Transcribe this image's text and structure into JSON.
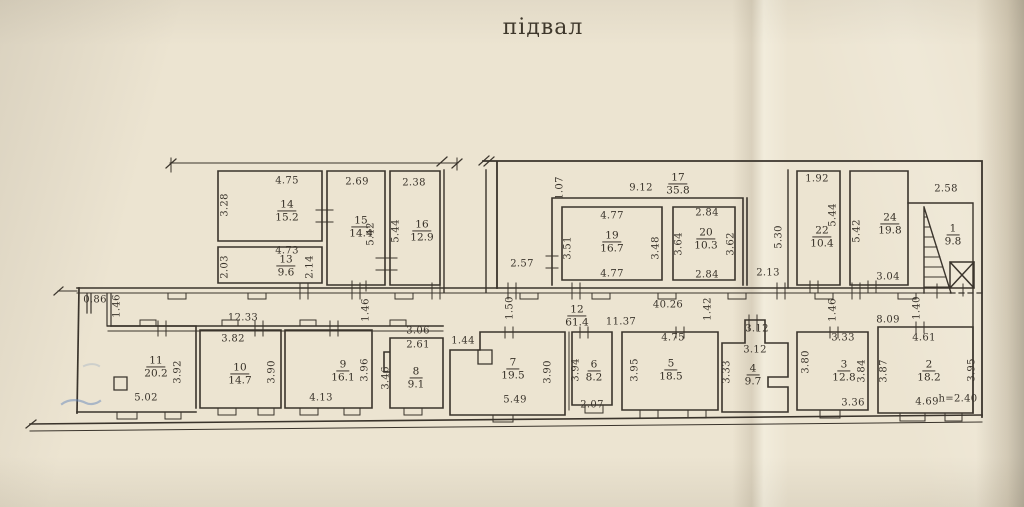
{
  "title": "підвал",
  "plan": {
    "ink": "#3a342c",
    "paper": "#ece4d1",
    "height_note": "h=2.40",
    "rooms": [
      {
        "number": "14",
        "area": "15.2",
        "x": 287,
        "y": 211
      },
      {
        "number": "13",
        "area": "9.6",
        "x": 286,
        "y": 266
      },
      {
        "number": "15",
        "area": "14.4",
        "x": 361,
        "y": 227
      },
      {
        "number": "16",
        "area": "12.9",
        "x": 422,
        "y": 231
      },
      {
        "number": "17",
        "area": "35.8",
        "x": 678,
        "y": 184
      },
      {
        "number": "19",
        "area": "16.7",
        "x": 612,
        "y": 242
      },
      {
        "number": "20",
        "area": "10.3",
        "x": 706,
        "y": 239
      },
      {
        "number": "22",
        "area": "10.4",
        "x": 822,
        "y": 237
      },
      {
        "number": "24",
        "area": "19.8",
        "x": 890,
        "y": 224
      },
      {
        "number": "1",
        "area": "9.8",
        "x": 953,
        "y": 235
      },
      {
        "number": "12",
        "area": "61.4",
        "x": 577,
        "y": 316
      },
      {
        "number": "11",
        "area": "20.2",
        "x": 156,
        "y": 367
      },
      {
        "number": "10",
        "area": "14.7",
        "x": 240,
        "y": 374
      },
      {
        "number": "9",
        "area": "16.1",
        "x": 343,
        "y": 371
      },
      {
        "number": "8",
        "area": "9.1",
        "x": 416,
        "y": 378
      },
      {
        "number": "7",
        "area": "19.5",
        "x": 513,
        "y": 369
      },
      {
        "number": "6",
        "area": "8.2",
        "x": 594,
        "y": 371
      },
      {
        "number": "5",
        "area": "18.5",
        "x": 671,
        "y": 370
      },
      {
        "number": "4",
        "area": "9.7",
        "x": 753,
        "y": 375
      },
      {
        "number": "3",
        "area": "12.8",
        "x": 844,
        "y": 371
      },
      {
        "number": "2",
        "area": "18.2",
        "x": 929,
        "y": 371
      }
    ],
    "dims": [
      {
        "t": "4.75",
        "x": 287,
        "y": 181
      },
      {
        "t": "3.28",
        "x": 225,
        "y": 205,
        "r": 1
      },
      {
        "t": "2.69",
        "x": 357,
        "y": 182
      },
      {
        "t": "2.38",
        "x": 414,
        "y": 183
      },
      {
        "t": "4.73",
        "x": 287,
        "y": 251
      },
      {
        "t": "2.03",
        "x": 225,
        "y": 267,
        "r": 1
      },
      {
        "t": "2.14",
        "x": 310,
        "y": 267,
        "r": 1
      },
      {
        "t": "5.42",
        "x": 371,
        "y": 234,
        "r": 1
      },
      {
        "t": "5.44",
        "x": 396,
        "y": 231,
        "r": 1
      },
      {
        "t": "1.07",
        "x": 560,
        "y": 188,
        "r": 1
      },
      {
        "t": "9.12",
        "x": 641,
        "y": 188
      },
      {
        "t": "4.77",
        "x": 612,
        "y": 216
      },
      {
        "t": "3.51",
        "x": 568,
        "y": 248,
        "r": 1
      },
      {
        "t": "3.48",
        "x": 656,
        "y": 248,
        "r": 1
      },
      {
        "t": "4.77",
        "x": 612,
        "y": 274
      },
      {
        "t": "2.84",
        "x": 707,
        "y": 213
      },
      {
        "t": "3.64",
        "x": 679,
        "y": 244,
        "r": 1
      },
      {
        "t": "3.62",
        "x": 731,
        "y": 244,
        "r": 1
      },
      {
        "t": "2.84",
        "x": 707,
        "y": 275
      },
      {
        "t": "2.57",
        "x": 522,
        "y": 264
      },
      {
        "t": "5.30",
        "x": 779,
        "y": 237,
        "r": 1
      },
      {
        "t": "2.13",
        "x": 768,
        "y": 273
      },
      {
        "t": "1.92",
        "x": 817,
        "y": 179
      },
      {
        "t": "5.44",
        "x": 833,
        "y": 215,
        "r": 1
      },
      {
        "t": "5.42",
        "x": 857,
        "y": 231,
        "r": 1
      },
      {
        "t": "3.04",
        "x": 888,
        "y": 277
      },
      {
        "t": "2.58",
        "x": 946,
        "y": 189
      },
      {
        "t": "0.86",
        "x": 95,
        "y": 300
      },
      {
        "t": "1.46",
        "x": 117,
        "y": 306,
        "r": 1
      },
      {
        "t": "12.33",
        "x": 243,
        "y": 318
      },
      {
        "t": "1.46",
        "x": 366,
        "y": 310,
        "r": 1
      },
      {
        "t": "1.50",
        "x": 510,
        "y": 308,
        "r": 1
      },
      {
        "t": "11.37",
        "x": 621,
        "y": 322
      },
      {
        "t": "40.26",
        "x": 668,
        "y": 305
      },
      {
        "t": "1.42",
        "x": 708,
        "y": 309,
        "r": 1
      },
      {
        "t": "3.12",
        "x": 757,
        "y": 329
      },
      {
        "t": "3.12",
        "x": 755,
        "y": 350
      },
      {
        "t": "1.46",
        "x": 833,
        "y": 310,
        "r": 1
      },
      {
        "t": "8.09",
        "x": 888,
        "y": 320
      },
      {
        "t": "1.40",
        "x": 917,
        "y": 308,
        "r": 1
      },
      {
        "t": "3.82",
        "x": 233,
        "y": 339
      },
      {
        "t": "3.92",
        "x": 178,
        "y": 372,
        "r": 1
      },
      {
        "t": "5.02",
        "x": 146,
        "y": 398
      },
      {
        "t": "3.90",
        "x": 272,
        "y": 372,
        "r": 1
      },
      {
        "t": "4.13",
        "x": 321,
        "y": 398
      },
      {
        "t": "3.96",
        "x": 365,
        "y": 370,
        "r": 1
      },
      {
        "t": "3.46",
        "x": 386,
        "y": 378,
        "r": 1
      },
      {
        "t": "3.06",
        "x": 418,
        "y": 331
      },
      {
        "t": "2.61",
        "x": 418,
        "y": 345
      },
      {
        "t": "1.44",
        "x": 463,
        "y": 341
      },
      {
        "t": "3.90",
        "x": 548,
        "y": 372,
        "r": 1
      },
      {
        "t": "5.49",
        "x": 515,
        "y": 400
      },
      {
        "t": "3.94",
        "x": 576,
        "y": 370,
        "r": 1
      },
      {
        "t": "2.07",
        "x": 592,
        "y": 405
      },
      {
        "t": "4.75",
        "x": 673,
        "y": 338
      },
      {
        "t": "3.95",
        "x": 635,
        "y": 370,
        "r": 1
      },
      {
        "t": "3.33",
        "x": 727,
        "y": 372,
        "r": 1
      },
      {
        "t": "3.33",
        "x": 843,
        "y": 338
      },
      {
        "t": "3.80",
        "x": 806,
        "y": 362,
        "r": 1
      },
      {
        "t": "3.84",
        "x": 862,
        "y": 371,
        "r": 1
      },
      {
        "t": "3.36",
        "x": 853,
        "y": 403
      },
      {
        "t": "4.61",
        "x": 924,
        "y": 338
      },
      {
        "t": "3.87",
        "x": 884,
        "y": 371,
        "r": 1
      },
      {
        "t": "3.95",
        "x": 972,
        "y": 370,
        "r": 1
      },
      {
        "t": "4.69",
        "x": 927,
        "y": 402
      },
      {
        "t": "h=2.40",
        "x": 958,
        "y": 399
      }
    ]
  }
}
